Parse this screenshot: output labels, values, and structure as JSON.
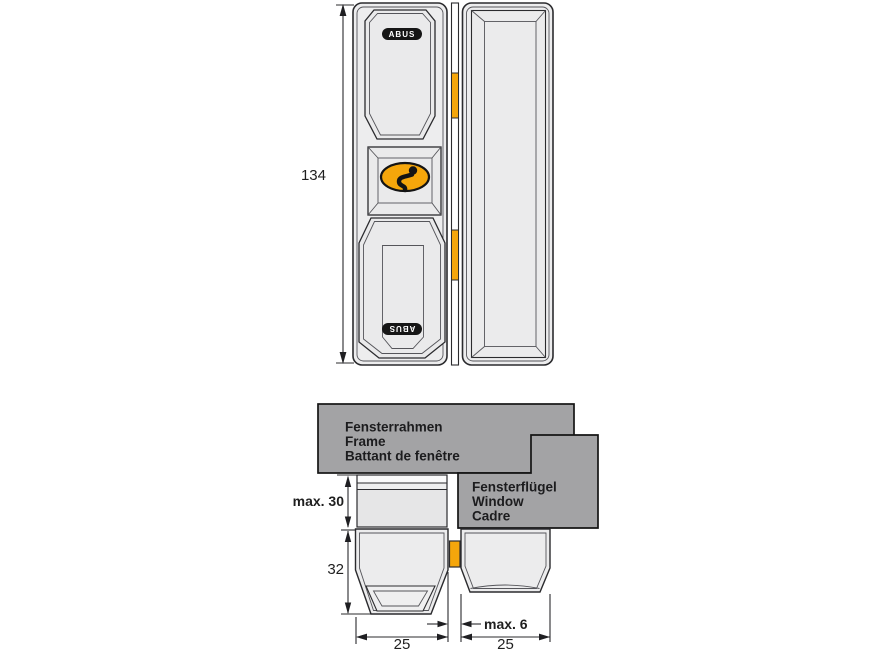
{
  "colors": {
    "accent_orange": "#F5A60B",
    "box_gray": "#A3A3A5",
    "part_fill": "#EDEDEE",
    "panel_fill": "#EAEAEB",
    "recess_fill": "#E6E6E8",
    "line_dark": "#2B2B2E"
  },
  "front_view": {
    "height_dim": "134",
    "brand_top": "ABUS",
    "brand_bottom": "ABUS"
  },
  "section_view": {
    "frame_box": {
      "lines": [
        "Fensterrahmen",
        "Frame",
        "Battant de fenêtre"
      ]
    },
    "sash_box": {
      "lines": [
        "Fensterflügel",
        "Window",
        "Cadre"
      ]
    },
    "dim_spacer_height": "max. 30",
    "dim_body_height": "32",
    "dim_body_width": "25",
    "dim_gap": "max. 6",
    "dim_keeper_width": "25"
  }
}
